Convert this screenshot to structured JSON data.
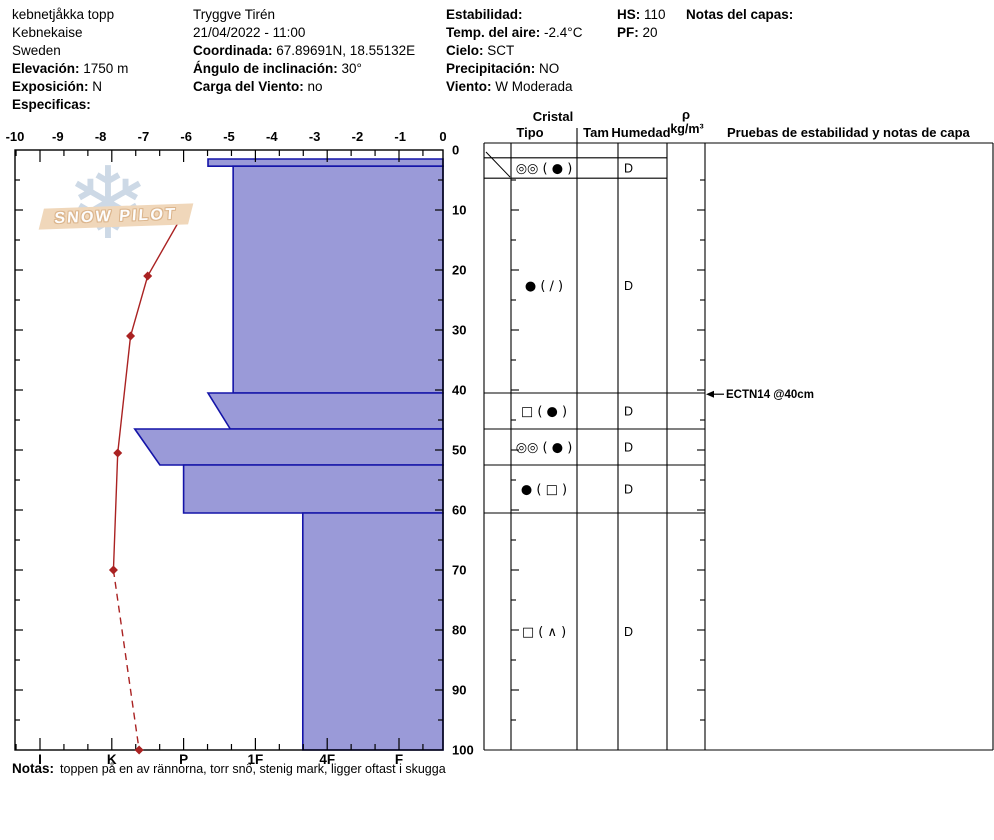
{
  "header": {
    "columns": [
      {
        "id": "site",
        "lines": [
          {
            "label": "",
            "value": "kebnetjåkka topp"
          },
          {
            "label": "",
            "value": "Kebnekaise"
          },
          {
            "label": "",
            "value": "Sweden"
          },
          {
            "label": "Elevación:",
            "value": "1750 m"
          },
          {
            "label": "Exposición:",
            "value": "N"
          },
          {
            "label": "Especificas:",
            "value": ""
          }
        ]
      },
      {
        "id": "observer",
        "lines": [
          {
            "label": "",
            "value": "Tryggve  Tirén"
          },
          {
            "label": "",
            "value": "21/04/2022 - 11:00"
          },
          {
            "label": "Coordinada:",
            "value": "67.89691N, 18.55132E"
          },
          {
            "label": "Ángulo de inclinación:",
            "value": "30°"
          },
          {
            "label": "Carga del Viento:",
            "value": "no"
          }
        ]
      },
      {
        "id": "conditions",
        "lines": [
          {
            "label": "Estabilidad:",
            "value": ""
          },
          {
            "label": "Temp. del aire:",
            "value": "-2.4°C"
          },
          {
            "label": "Cielo:",
            "value": "SCT"
          },
          {
            "label": "Precipitación:",
            "value": "NO"
          },
          {
            "label": "Viento:",
            "value": "W Moderada"
          }
        ]
      },
      {
        "id": "snow-depth",
        "lines": [
          {
            "label": "HS:",
            "value": "110"
          },
          {
            "label": "PF:",
            "value": "20"
          }
        ]
      },
      {
        "id": "layer-notes",
        "lines": [
          {
            "label": "Notas del capas:",
            "value": ""
          }
        ]
      }
    ]
  },
  "logo": {
    "text": "SNOW PILOT",
    "flake_icon": "❄"
  },
  "notes": {
    "label": "Notas:",
    "text": "toppen på en av rännorna, torr snö, stenig mark, ligger oftast i skugga"
  },
  "colors": {
    "layer_fill": "#9a9ad8",
    "layer_stroke": "#1414a8",
    "temp_line": "#aa2222",
    "axis": "#000000",
    "logo_banner": "#f0d7ba",
    "logo_flake": "#cdd9e6"
  },
  "chart_data": {
    "type": "snow-profile",
    "title": "",
    "temp_axis": {
      "side": "top",
      "unit": "°C",
      "min": -10,
      "max": 0,
      "ticks": [
        -10,
        -9,
        -8,
        -7,
        -6,
        -5,
        -4,
        -3,
        -2,
        -1,
        0
      ]
    },
    "depth_axis": {
      "side": "right-of-plot",
      "unit": "cm",
      "min": 0,
      "max": 100,
      "ticks": [
        0,
        10,
        20,
        30,
        40,
        50,
        60,
        70,
        80,
        90,
        100
      ]
    },
    "hardness_axis": {
      "side": "bottom",
      "categories": [
        "I",
        "K",
        "P",
        "1F",
        "4F",
        "F"
      ]
    },
    "layers": [
      {
        "from_depth": 1.5,
        "to_depth": 2.7,
        "hardness_top": 3.34,
        "hardness_bottom": 3.34
      },
      {
        "from_depth": 2.7,
        "to_depth": 40.5,
        "hardness_top": 3.69,
        "hardness_bottom": 3.69
      },
      {
        "from_depth": 40.5,
        "to_depth": 46.5,
        "hardness_top": 3.34,
        "hardness_bottom": 3.65
      },
      {
        "from_depth": 46.5,
        "to_depth": 52.5,
        "hardness_top": 2.32,
        "hardness_bottom": 2.67
      },
      {
        "from_depth": 52.5,
        "to_depth": 60.5,
        "hardness_top": 3.0,
        "hardness_bottom": 3.0
      },
      {
        "from_depth": 60.5,
        "to_depth": 100,
        "hardness_top": 4.66,
        "hardness_bottom": 4.66
      }
    ],
    "temperature_profile": [
      {
        "depth": 11,
        "temp": -6.1
      },
      {
        "depth": 21,
        "temp": -6.9
      },
      {
        "depth": 31,
        "temp": -7.3
      },
      {
        "depth": 50.5,
        "temp": -7.6
      },
      {
        "depth": 70,
        "temp": -7.7
      },
      {
        "depth": 100,
        "temp": -7.1
      }
    ],
    "temperature_dashed_from_point": 4,
    "grain_table": {
      "headers": {
        "cristal": "Cristal",
        "tipo": "Tipo",
        "tam": "Tam",
        "humedad": "Humedad",
        "density_rho": "ρ",
        "density_unit": "kg/m³",
        "tests": "Pruebas de estabilidad y notas de capa"
      },
      "rows": [
        {
          "from_depth": 1.3,
          "to_depth": 4.7,
          "tipo": "◎◎ ( ● )",
          "tam": "",
          "humedad": "D"
        },
        {
          "from_depth": 4.7,
          "to_depth": 40.5,
          "tipo": "● ( ∕ )",
          "tam": "",
          "humedad": "D"
        },
        {
          "from_depth": 40.5,
          "to_depth": 46.5,
          "tipo": "□ ( ● )",
          "tam": "",
          "humedad": "D"
        },
        {
          "from_depth": 46.5,
          "to_depth": 52.5,
          "tipo": "◎◎ ( ● )",
          "tam": "",
          "humedad": "D"
        },
        {
          "from_depth": 52.5,
          "to_depth": 60.5,
          "tipo": "● ( □ )",
          "tam": "",
          "humedad": "D"
        },
        {
          "from_depth": 60.5,
          "to_depth": 100,
          "tipo": "□ ( ∧ )",
          "tam": "",
          "humedad": "D"
        }
      ],
      "tests": [
        {
          "label": "ECTN14 @40cm",
          "depth": 40.7
        }
      ]
    }
  }
}
